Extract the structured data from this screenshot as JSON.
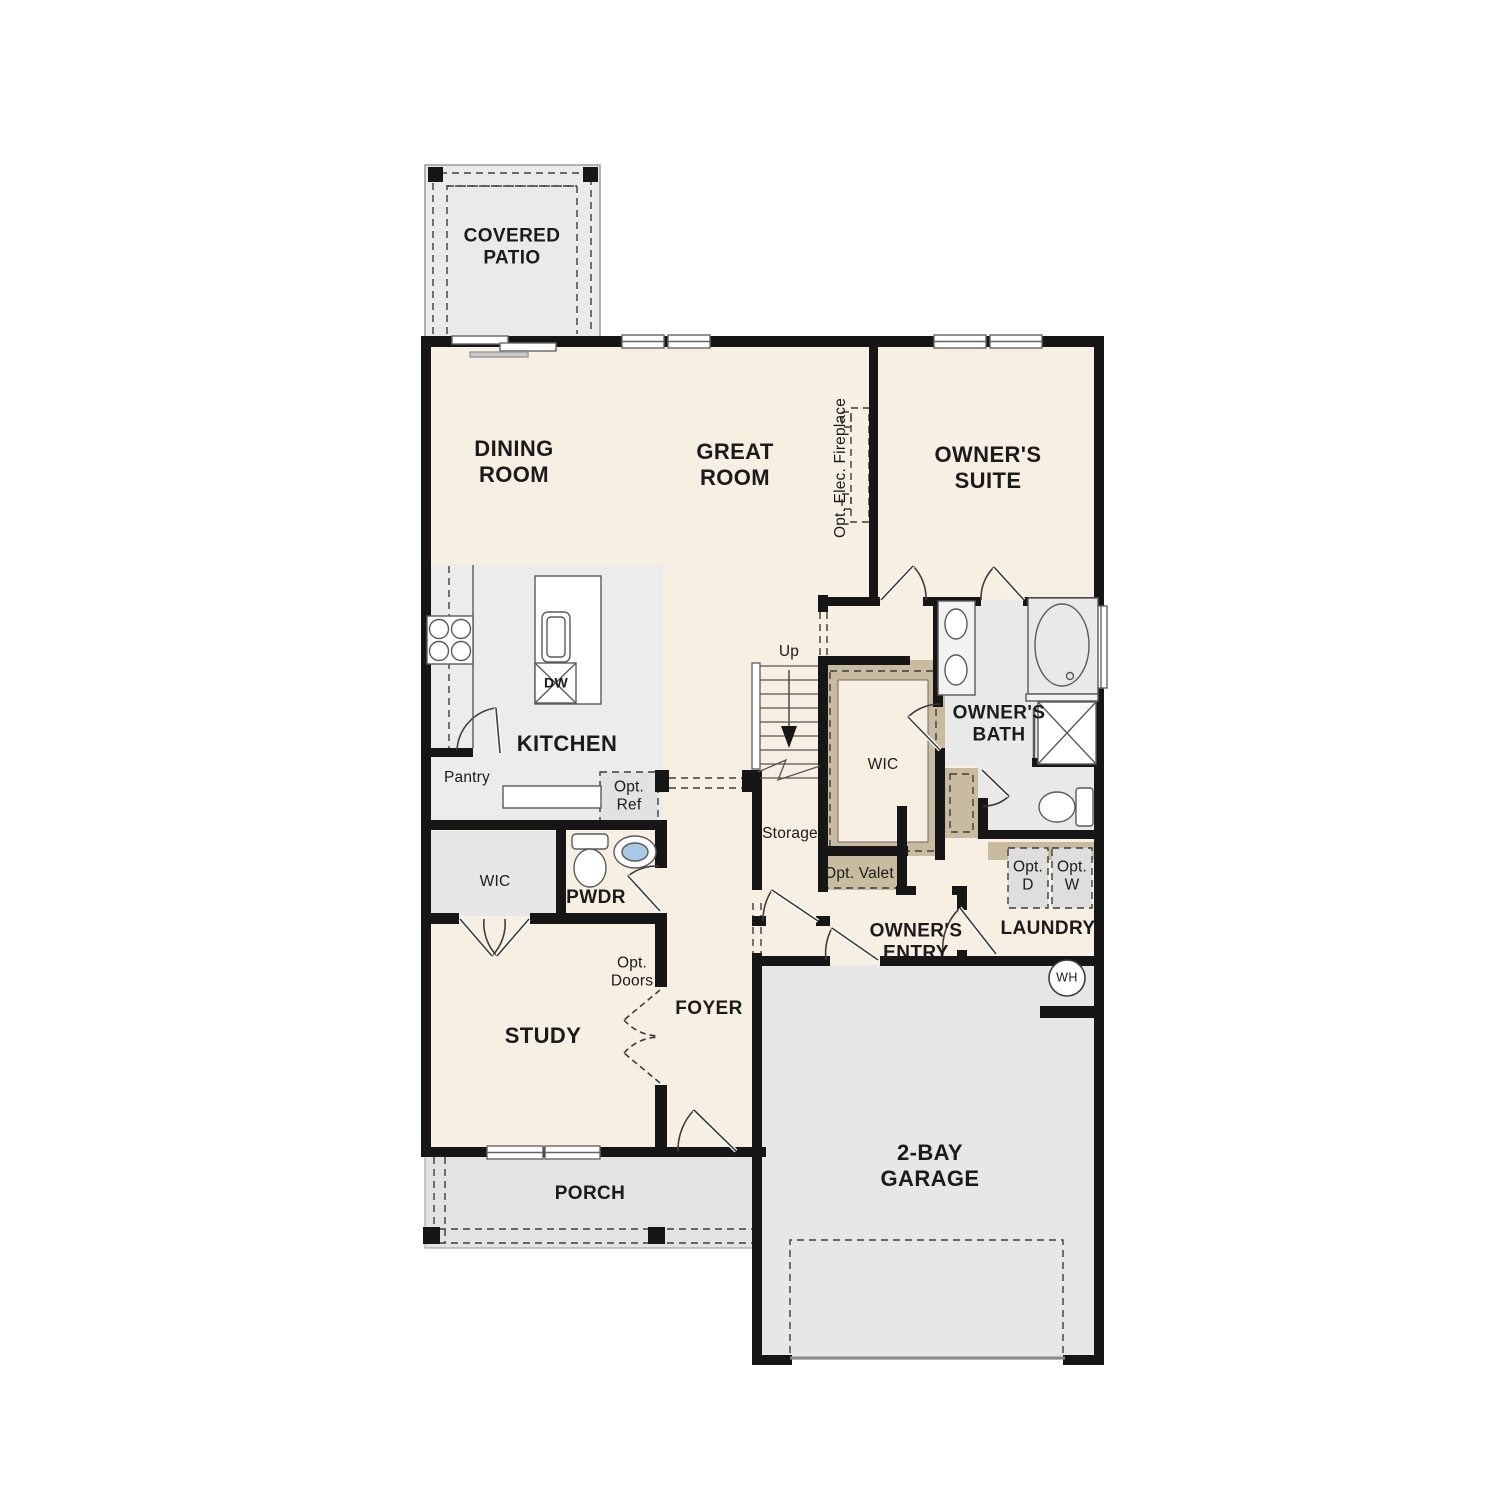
{
  "plan": {
    "type": "single-story floor plan",
    "labels": {
      "covered_patio": "COVERED\nPATIO",
      "dining_room": "DINING\nROOM",
      "great_room": "GREAT\nROOM",
      "opt_elec_fireplace": "Opt. Elec. Fireplace",
      "owners_suite": "OWNER'S\nSUITE",
      "kitchen": "KITCHEN",
      "dishwasher": "DW",
      "pantry": "Pantry",
      "opt_ref": "Opt.\nRef",
      "stairs_up": "Up",
      "storage": "Storage",
      "wic_owners": "WIC",
      "owners_bath": "OWNER'S\nBATH",
      "opt_valet": "Opt. Valet",
      "wic_study": "WIC",
      "powder_room": "PWDR",
      "study": "STUDY",
      "opt_doors": "Opt.\nDoors",
      "foyer": "FOYER",
      "owners_entry": "OWNER'S\nENTRY",
      "laundry": "LAUNDRY",
      "opt_dryer": "Opt.\nD",
      "opt_washer": "Opt.\nW",
      "water_heater": "WH",
      "garage": "2-BAY\nGARAGE",
      "porch": "PORCH"
    },
    "colors": {
      "floor_cream": "#f7efe2",
      "zone_gray": "#eaeaea",
      "shelf_tan": "#c9bba0",
      "wall_black": "#161616",
      "fixture_line": "#5a5a5a",
      "sink_blue": "#a9c9e6",
      "appliance_gray": "#dedede"
    }
  }
}
